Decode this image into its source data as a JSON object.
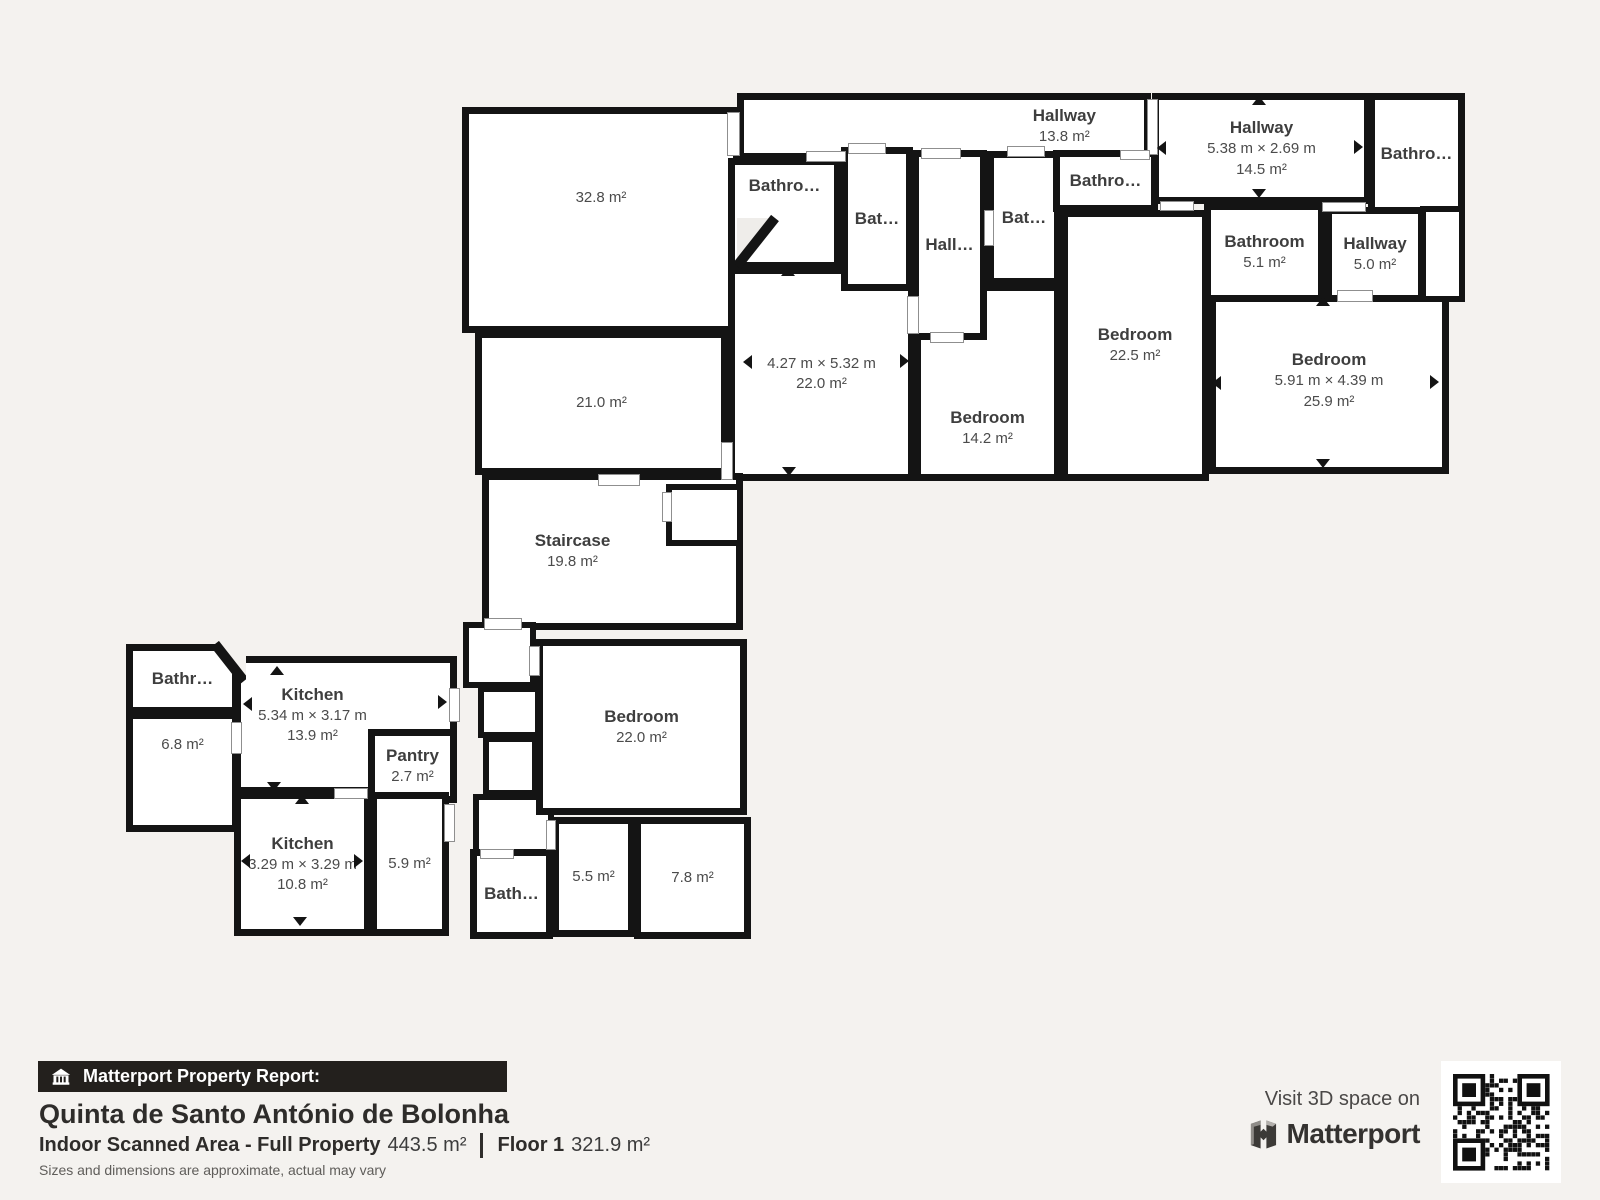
{
  "plan": {
    "rooms": {
      "area328": {
        "area": "32.8 m²"
      },
      "area210": {
        "area": "21.0 m²"
      },
      "hallway138": {
        "name": "Hallway",
        "area": "13.8 m²"
      },
      "hallway145": {
        "name": "Hallway",
        "dims": "5.38 m × 2.69 m",
        "area": "14.5 m²"
      },
      "bathroomTR": {
        "name": "Bathro…"
      },
      "bathroomA": {
        "name": "Bathro…"
      },
      "bathroomB": {
        "name": "Bat…"
      },
      "bathroomC": {
        "name": "Bat…"
      },
      "bathroomD": {
        "name": "Bathro…"
      },
      "hallC": {
        "name": "Hall…"
      },
      "bathroom51": {
        "name": "Bathroom",
        "area": "5.1 m²"
      },
      "hallway50": {
        "name": "Hallway",
        "area": "5.0 m²"
      },
      "room220": {
        "dims": "4.27 m × 5.32 m",
        "area": "22.0 m²"
      },
      "bedroom142": {
        "name": "Bedroom",
        "area": "14.2 m²"
      },
      "bedroom225": {
        "name": "Bedroom",
        "area": "22.5 m²"
      },
      "bedroom259": {
        "name": "Bedroom",
        "dims": "5.91 m × 4.39 m",
        "area": "25.9 m²"
      },
      "staircase": {
        "name": "Staircase",
        "area": "19.8 m²"
      },
      "bathroomE": {
        "name": "Bathr…"
      },
      "area68": {
        "area": "6.8 m²"
      },
      "kitchen139": {
        "name": "Kitchen",
        "dims": "5.34 m × 3.17 m",
        "area": "13.9 m²"
      },
      "pantry": {
        "name": "Pantry",
        "area": "2.7 m²"
      },
      "kitchen108": {
        "name": "Kitchen",
        "dims": "3.29 m × 3.29 m",
        "area": "10.8 m²"
      },
      "area59": {
        "area": "5.9 m²"
      },
      "bathroomF": {
        "name": "Bath…"
      },
      "area55": {
        "area": "5.5 m²"
      },
      "area78": {
        "area": "7.8 m²"
      },
      "bedroom220": {
        "name": "Bedroom",
        "area": "22.0 m²"
      }
    }
  },
  "footer": {
    "report_label": "Matterport Property Report:",
    "property_name": "Quinta de Santo António de Bolonha",
    "scanned_area_label": "Indoor Scanned Area - Full Property",
    "scanned_area_value": "443.5 m²",
    "floor_label": "Floor 1",
    "floor_value": "321.9 m²",
    "disclaimer": "Sizes and dimensions are approximate, actual may vary"
  },
  "promo": {
    "visit_text": "Visit 3D space on",
    "brand": "Matterport"
  },
  "colors": {
    "background": "#f4f2ef",
    "wall": "#141414",
    "room_fill": "#ffffff",
    "label_text": "#3e3e3e",
    "bar_bg": "#23201d"
  }
}
